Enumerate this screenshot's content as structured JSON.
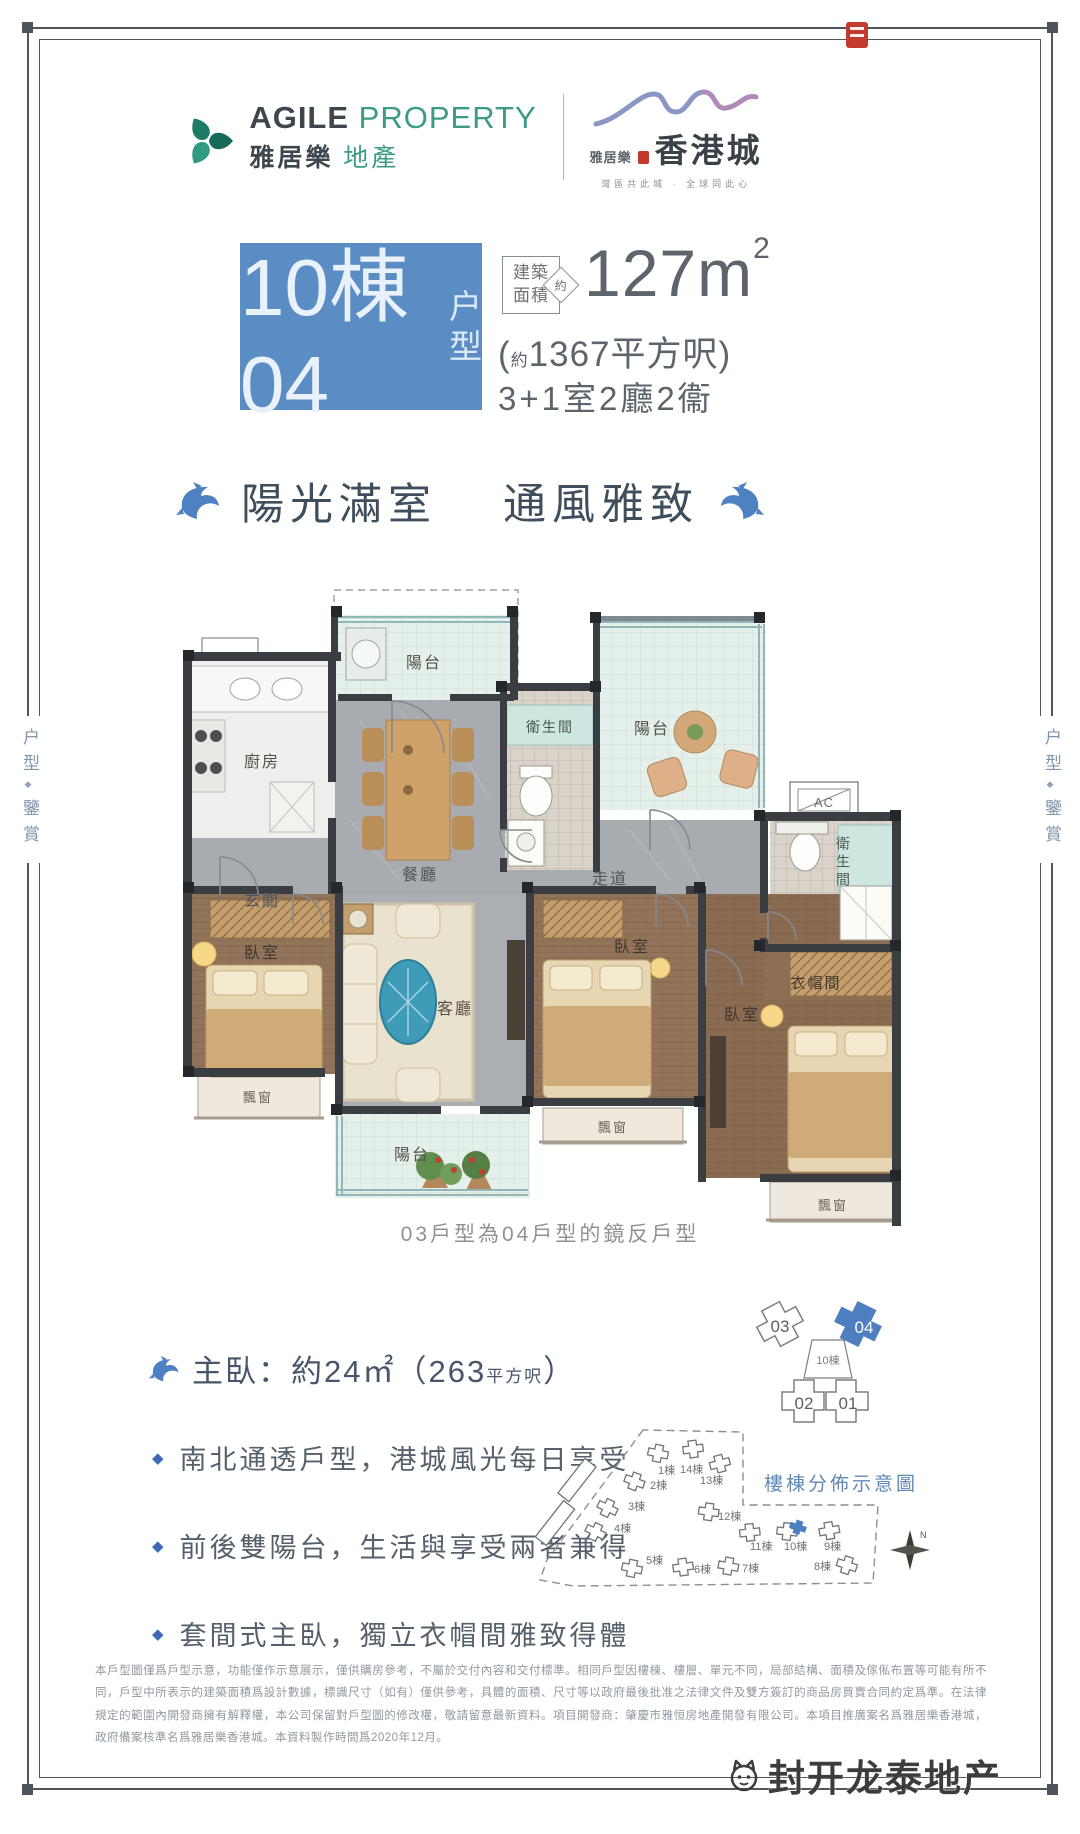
{
  "frame": {
    "color": "#50555b"
  },
  "side_label": {
    "part1": "户型",
    "separator": "◆",
    "part2": "鑒賞"
  },
  "header": {
    "agile_en_bold": "AGILE",
    "agile_en_light": "PROPERTY",
    "agile_cn_bold": "雅居樂",
    "agile_cn_light": "地產",
    "hk_small": "雅居樂",
    "hk_main": "香港城",
    "hk_tagline": "灣區共此城 · 全球同此心"
  },
  "title": {
    "block_main": "10棟04",
    "block_suffix": "户型",
    "badge_line1": "建築",
    "badge_line2": "面積",
    "badge_diamond": "約",
    "area_value": "127m",
    "area_sup": "2",
    "paren_open": "(",
    "paren_approx": "約",
    "paren_rest": "1367平方呎)",
    "layout_text": "3+1室2廳2衞",
    "block_bg": "#5b8dc5"
  },
  "slogan": {
    "left": "陽光滿室",
    "right": "通風雅致"
  },
  "floor_plan": {
    "rooms": {
      "balcony_top": "陽台",
      "kitchen": "廚房",
      "bath_top": "衛生間",
      "balcony_right": "陽台",
      "dining": "餐廳",
      "foyer": "玄關",
      "corridor": "走道",
      "bedroom_left": "臥室",
      "living": "客廳",
      "bedroom_middle": "臥室",
      "bedroom_right": "臥室",
      "closet": "衣帽間",
      "bath_right": "衛生間",
      "bay_left": "飄窗",
      "bay_middle": "飄窗",
      "bay_right": "飄窗",
      "balcony_bottom": "陽台",
      "ac": "AC"
    },
    "caption": "03戶型為04戶型的鏡反戶型"
  },
  "key_plan": {
    "unit_03": "03",
    "unit_04": "04",
    "unit_02": "02",
    "unit_01": "01",
    "center": "10棟",
    "highlight_color": "#4d7fc0"
  },
  "master_bedroom": {
    "text": "主臥：約24㎡（263",
    "small": "平方呎",
    "close": "）"
  },
  "highlights": {
    "bullet": "◆",
    "items": [
      "南北通透戶型，港城風光每日享受",
      "前後雙陽台，生活與享受兩者兼得",
      "套間式主臥，獨立衣帽間雅致得體"
    ]
  },
  "site_plan": {
    "title": "樓棟分佈示意圖",
    "compass": "N",
    "buildings": [
      "1棟",
      "14棟",
      "2棟",
      "13棟",
      "3棟",
      "12棟",
      "4棟",
      "11棟",
      "10棟",
      "9棟",
      "5棟",
      "6棟",
      "7棟",
      "8棟"
    ],
    "highlighted": "10棟"
  },
  "disclaimer": "本戶型圖僅爲戶型示意，功能僅作示意展示，僅供購房參考，不屬於交付內容和交付標準。相同戶型因樓棟、樓層、單元不同，局部結構、面積及傢俬布置等可能有所不同，戶型中所表示的建築面積爲設計數據，標識尺寸（如有）僅供參考，具體的面積、尺寸等以政府最後批准之法律文件及雙方簽訂的商品房買賣合同約定爲準。在法律規定的範圍內開發商擁有解釋權，本公司保留對戶型圖的修改權，敬請留意最新資料。項目開發商：肇慶市雅恒房地產開發有限公司。本項目推廣案名爲雅居樂香港城，政府備案核準名爲雅居樂香港城。本資料製作時間爲2020年12月。",
  "watermark": "封开龙泰地产"
}
